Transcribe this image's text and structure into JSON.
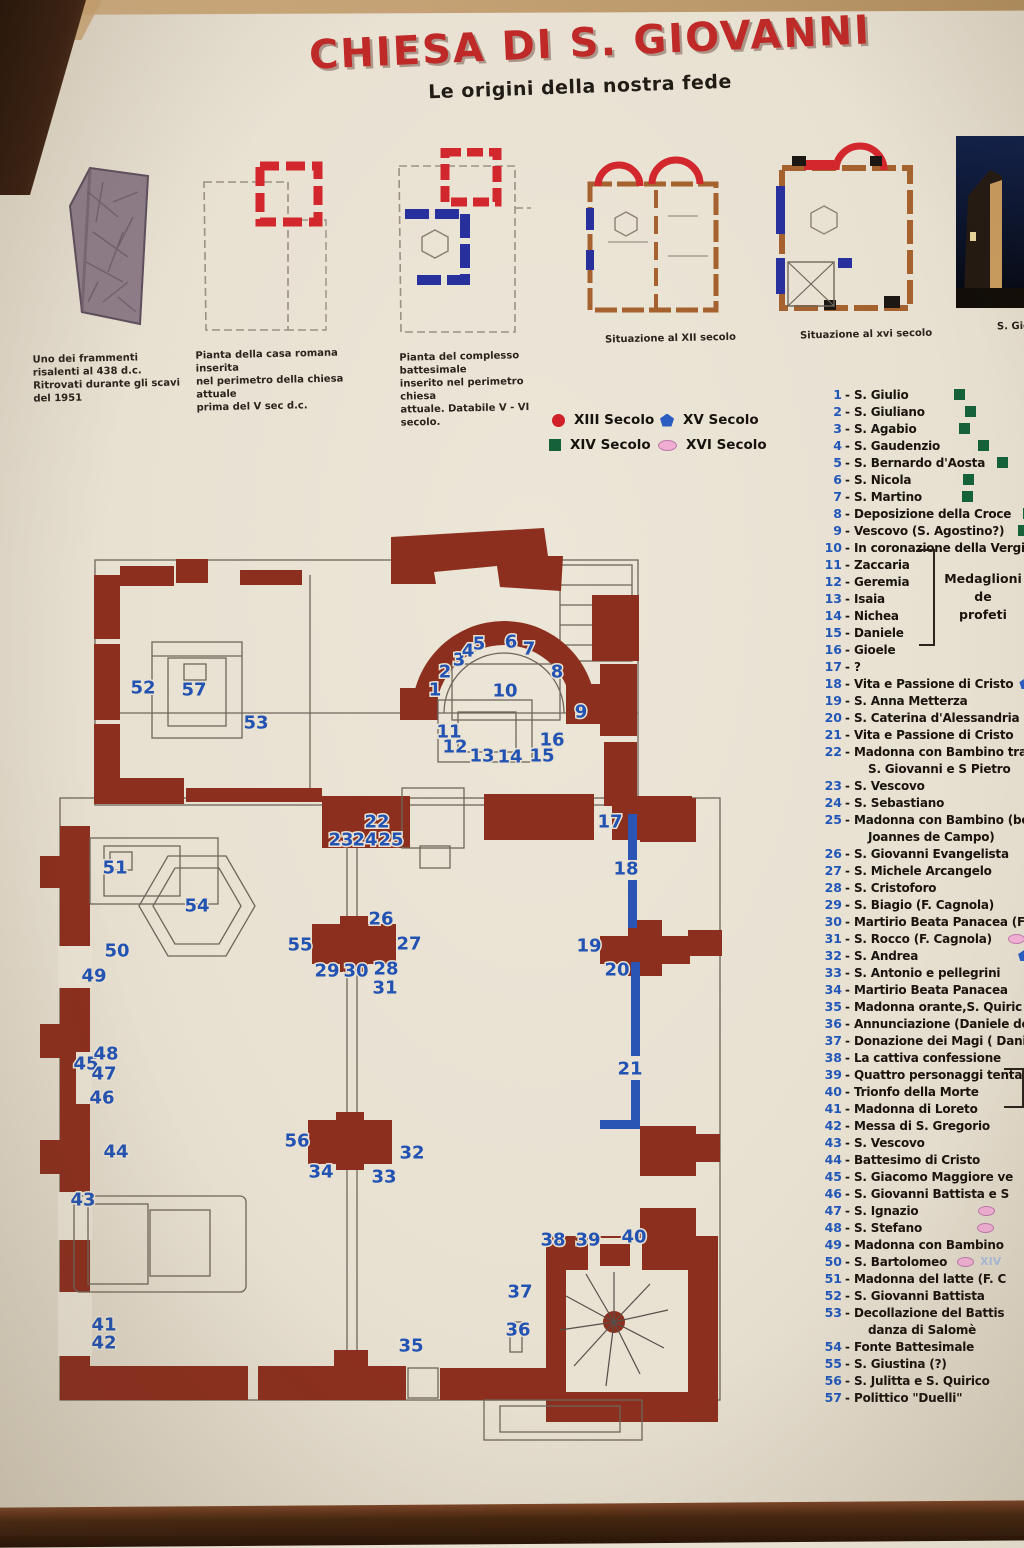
{
  "header": {
    "title": "CHIESA DI S. GIOVANNI",
    "subtitle": "Le origini della nostra fede"
  },
  "colors": {
    "title_red": "#bf2a28",
    "plan_red": "#8c2f1e",
    "numbers_blue": "#2353b2",
    "legend_red": "#cf2127",
    "legend_green": "#15613a",
    "legend_blue": "#2b5cc0",
    "legend_pink": "#efaed2",
    "panel_cream": "#e9e2d3"
  },
  "figures": [
    {
      "id": "fragment",
      "caption": "Uno dei frammenti risalenti al 438 d.c.\nRitrovati durante gli scavi del 1951"
    },
    {
      "id": "casa-romana",
      "caption": "Pianta della casa romana inserita\nnel perimetro della chiesa attuale\nprima del V sec d.c."
    },
    {
      "id": "complesso-battesimale",
      "caption": "Pianta del complesso battesimale\ninserito nel perimetro chiesa\nattuale. Databile V - VI secolo."
    },
    {
      "id": "situazione-xii",
      "caption": "Situazione al XII secolo"
    },
    {
      "id": "situazione-xvi",
      "caption": "Situazione al xvi secolo"
    },
    {
      "id": "church-photo",
      "caption": "S. Gio"
    }
  ],
  "legend": [
    {
      "label": "XIII Secolo",
      "shape": "circle",
      "color": "#cf2127"
    },
    {
      "label": "XV Secolo",
      "shape": "pentagon",
      "color": "#2b5cc0"
    },
    {
      "label": "XIV Secolo",
      "shape": "square",
      "color": "#15613a"
    },
    {
      "label": "XVI Secolo",
      "shape": "ellipse",
      "color": "#efaed2"
    }
  ],
  "notes": {
    "medaglioni_line1": "Medaglioni de",
    "medaglioni_line2": "profeti",
    "xiv_faint": "XIV"
  },
  "plan_numbers": [
    {
      "n": "1",
      "x": 435,
      "y": 690
    },
    {
      "n": "2",
      "x": 445,
      "y": 672
    },
    {
      "n": "3",
      "x": 459,
      "y": 660
    },
    {
      "n": "4",
      "x": 468,
      "y": 651
    },
    {
      "n": "5",
      "x": 479,
      "y": 644
    },
    {
      "n": "6",
      "x": 511,
      "y": 642
    },
    {
      "n": "7",
      "x": 529,
      "y": 649
    },
    {
      "n": "8",
      "x": 557,
      "y": 672
    },
    {
      "n": "9",
      "x": 581,
      "y": 712
    },
    {
      "n": "10",
      "x": 505,
      "y": 691
    },
    {
      "n": "11",
      "x": 449,
      "y": 732
    },
    {
      "n": "12",
      "x": 455,
      "y": 747
    },
    {
      "n": "13",
      "x": 482,
      "y": 756
    },
    {
      "n": "14",
      "x": 510,
      "y": 757
    },
    {
      "n": "15",
      "x": 542,
      "y": 756
    },
    {
      "n": "16",
      "x": 552,
      "y": 740
    },
    {
      "n": "17",
      "x": 610,
      "y": 822
    },
    {
      "n": "18",
      "x": 626,
      "y": 869
    },
    {
      "n": "19",
      "x": 589,
      "y": 946
    },
    {
      "n": "20",
      "x": 617,
      "y": 970
    },
    {
      "n": "21",
      "x": 630,
      "y": 1069
    },
    {
      "n": "22",
      "x": 377,
      "y": 822
    },
    {
      "n": "23",
      "x": 341,
      "y": 840
    },
    {
      "n": "24",
      "x": 365,
      "y": 840
    },
    {
      "n": "25",
      "x": 391,
      "y": 840
    },
    {
      "n": "26",
      "x": 381,
      "y": 919
    },
    {
      "n": "27",
      "x": 409,
      "y": 944
    },
    {
      "n": "28",
      "x": 386,
      "y": 969
    },
    {
      "n": "29",
      "x": 327,
      "y": 971
    },
    {
      "n": "30",
      "x": 356,
      "y": 971
    },
    {
      "n": "31",
      "x": 385,
      "y": 988
    },
    {
      "n": "32",
      "x": 412,
      "y": 1153
    },
    {
      "n": "33",
      "x": 384,
      "y": 1177
    },
    {
      "n": "34",
      "x": 321,
      "y": 1172
    },
    {
      "n": "35",
      "x": 411,
      "y": 1346
    },
    {
      "n": "36",
      "x": 518,
      "y": 1330
    },
    {
      "n": "37",
      "x": 520,
      "y": 1292
    },
    {
      "n": "38",
      "x": 553,
      "y": 1240
    },
    {
      "n": "39",
      "x": 588,
      "y": 1240
    },
    {
      "n": "40",
      "x": 634,
      "y": 1237
    },
    {
      "n": "41",
      "x": 104,
      "y": 1325
    },
    {
      "n": "42",
      "x": 104,
      "y": 1343
    },
    {
      "n": "43",
      "x": 83,
      "y": 1200
    },
    {
      "n": "44",
      "x": 116,
      "y": 1152
    },
    {
      "n": "45",
      "x": 86,
      "y": 1064
    },
    {
      "n": "46",
      "x": 102,
      "y": 1098
    },
    {
      "n": "47",
      "x": 104,
      "y": 1074
    },
    {
      "n": "48",
      "x": 106,
      "y": 1054
    },
    {
      "n": "49",
      "x": 94,
      "y": 976
    },
    {
      "n": "50",
      "x": 117,
      "y": 951
    },
    {
      "n": "51",
      "x": 115,
      "y": 868
    },
    {
      "n": "52",
      "x": 143,
      "y": 688
    },
    {
      "n": "53",
      "x": 256,
      "y": 723
    },
    {
      "n": "54",
      "x": 197,
      "y": 906
    },
    {
      "n": "55",
      "x": 300,
      "y": 945
    },
    {
      "n": "56",
      "x": 297,
      "y": 1141
    },
    {
      "n": "57",
      "x": 194,
      "y": 690
    }
  ],
  "list": [
    {
      "n": "1",
      "text": "S. Giulio",
      "marker": "green-square",
      "gap": 45
    },
    {
      "n": "2",
      "text": "S. Giuliano",
      "marker": "green-square",
      "gap": 40
    },
    {
      "n": "3",
      "text": "S. Agabio",
      "marker": "green-square",
      "gap": 42
    },
    {
      "n": "4",
      "text": "S. Gaudenzio",
      "marker": "green-square",
      "gap": 38
    },
    {
      "n": "5",
      "text": "S. Bernardo d'Aosta",
      "marker": "green-square",
      "gap": 12
    },
    {
      "n": "6",
      "text": "S. Nicola",
      "marker": "green-square",
      "gap": 52
    },
    {
      "n": "7",
      "text": "S. Martino",
      "marker": "green-square",
      "gap": 40
    },
    {
      "n": "8",
      "text": "Deposizione della Croce",
      "marker": "green-square",
      "gap": 12
    },
    {
      "n": "9",
      "text": "Vescovo (S. Agostino?)",
      "marker": "green-square",
      "gap": 14
    },
    {
      "n": "10",
      "text": "In coronazione della Vergine"
    },
    {
      "n": "11",
      "text": "Zaccaria"
    },
    {
      "n": "12",
      "text": "Geremia"
    },
    {
      "n": "13",
      "text": "Isaia"
    },
    {
      "n": "14",
      "text": "Nichea"
    },
    {
      "n": "15",
      "text": "Daniele"
    },
    {
      "n": "16",
      "text": "Gioele"
    },
    {
      "n": "17",
      "text": "?"
    },
    {
      "n": "18",
      "text": "Vita e Passione di Cristo",
      "marker": "blue-pent",
      "gap": 6
    },
    {
      "n": "19",
      "text": "S. Anna Metterza",
      "marker": "blue-bar",
      "gap": 60
    },
    {
      "n": "20",
      "text": "S. Caterina d'Alessandria"
    },
    {
      "n": "21",
      "text": "Vita e Passione di Cristo"
    },
    {
      "n": "22",
      "lines": [
        "Madonna con Bambino tra",
        "S. Giovanni e S Pietro"
      ]
    },
    {
      "n": "23",
      "text": "S. Vescovo"
    },
    {
      "n": "24",
      "text": "S. Sebastiano"
    },
    {
      "n": "25",
      "lines": [
        "Madonna con Bambino (bott",
        "Joannes de Campo)"
      ]
    },
    {
      "n": "26",
      "text": "S. Giovanni Evangelista"
    },
    {
      "n": "27",
      "text": "S. Michele Arcangelo"
    },
    {
      "n": "28",
      "text": "S. Cristoforo"
    },
    {
      "n": "29",
      "text": "S. Biagio (F. Cagnola)"
    },
    {
      "n": "30",
      "text": "Martirio Beata Panacea (F"
    },
    {
      "n": "31",
      "text": "S. Rocco (F. Cagnola)",
      "marker": "pink-ellipse",
      "gap": 16
    },
    {
      "n": "32",
      "text": "S. Andrea",
      "marker": "blue-pent",
      "gap": 100
    },
    {
      "n": "33",
      "text": "S. Antonio e pellegrini",
      "marker": "blue-pent",
      "gap": 32
    },
    {
      "n": "34",
      "text": "Martirio Beata Panacea",
      "marker": "blue-pent",
      "gap": 30
    },
    {
      "n": "35",
      "text": "Madonna orante,S. Quiric"
    },
    {
      "n": "36",
      "text": "Annunciazione (Daniele de"
    },
    {
      "n": "37",
      "text": "Donazione dei Magi ( Dani"
    },
    {
      "n": "38",
      "text": "La cattiva confessione"
    },
    {
      "n": "39",
      "text": "Quattro personaggi tenta"
    },
    {
      "n": "40",
      "text": "Trionfo della Morte"
    },
    {
      "n": "41",
      "text": "Madonna di Loreto"
    },
    {
      "n": "42",
      "text": "Messa di S. Gregorio"
    },
    {
      "n": "43",
      "text": "S. Vescovo"
    },
    {
      "n": "44",
      "text": "Battesimo di Cristo"
    },
    {
      "n": "45",
      "text": "S. Giacomo Maggiore ve"
    },
    {
      "n": "46",
      "text": "S. Giovanni Battista e S"
    },
    {
      "n": "47",
      "text": "S. Ignazio",
      "marker": "pink-ellipse",
      "gap": 60
    },
    {
      "n": "48",
      "text": "S. Stefano",
      "marker": "pink-ellipse",
      "gap": 55
    },
    {
      "n": "49",
      "text": "Madonna con Bambino"
    },
    {
      "n": "50",
      "text": "S. Bartolomeo",
      "marker": "pink-ellipse",
      "gap": 10,
      "suffix": "XIV"
    },
    {
      "n": "51",
      "text": "Madonna del latte (F. C"
    },
    {
      "n": "52",
      "text": "S. Giovanni Battista"
    },
    {
      "n": "53",
      "lines": [
        "Decollazione del Battis",
        "danza di Salomè"
      ]
    },
    {
      "n": "54",
      "text": "Fonte Battesimale"
    },
    {
      "n": "55",
      "text": "S. Giustina (?)"
    },
    {
      "n": "56",
      "text": "S. Julitta e S. Quirico"
    },
    {
      "n": "57",
      "text": "Polittico \"Duelli\""
    }
  ]
}
